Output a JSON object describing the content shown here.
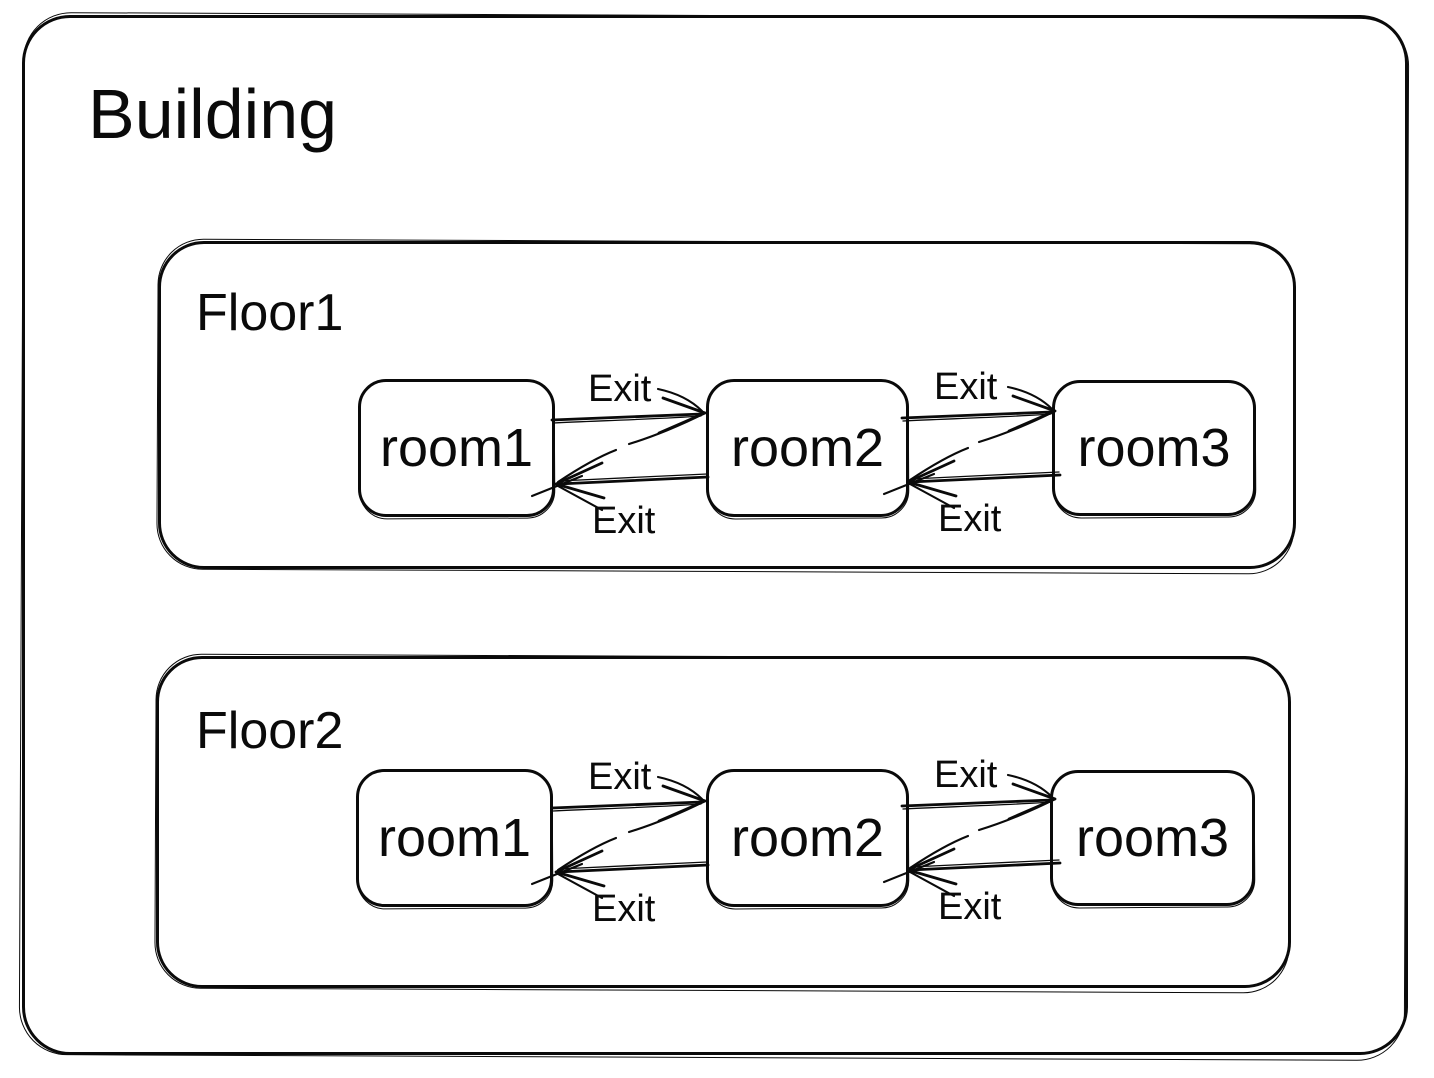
{
  "diagram": {
    "type": "nested-state-diagram",
    "style": {
      "stroke_color": "#0a0a0a",
      "background_color": "#ffffff",
      "look": "hand-sketch"
    },
    "building": {
      "label": "Building"
    },
    "floors": [
      {
        "label": "Floor1",
        "rooms": [
          {
            "label": "room1"
          },
          {
            "label": "room2"
          },
          {
            "label": "room3"
          }
        ],
        "transitions": [
          {
            "from": "room1",
            "to": "room2",
            "label": "Exit",
            "direction": "right"
          },
          {
            "from": "room2",
            "to": "room1",
            "label": "Exit",
            "direction": "left"
          },
          {
            "from": "room2",
            "to": "room3",
            "label": "Exit",
            "direction": "right"
          },
          {
            "from": "room3",
            "to": "room2",
            "label": "Exit",
            "direction": "left"
          }
        ]
      },
      {
        "label": "Floor2",
        "rooms": [
          {
            "label": "room1"
          },
          {
            "label": "room2"
          },
          {
            "label": "room3"
          }
        ],
        "transitions": [
          {
            "from": "room1",
            "to": "room2",
            "label": "Exit",
            "direction": "right"
          },
          {
            "from": "room2",
            "to": "room1",
            "label": "Exit",
            "direction": "left"
          },
          {
            "from": "room2",
            "to": "room3",
            "label": "Exit",
            "direction": "right"
          },
          {
            "from": "room3",
            "to": "room2",
            "label": "Exit",
            "direction": "left"
          }
        ]
      }
    ]
  }
}
